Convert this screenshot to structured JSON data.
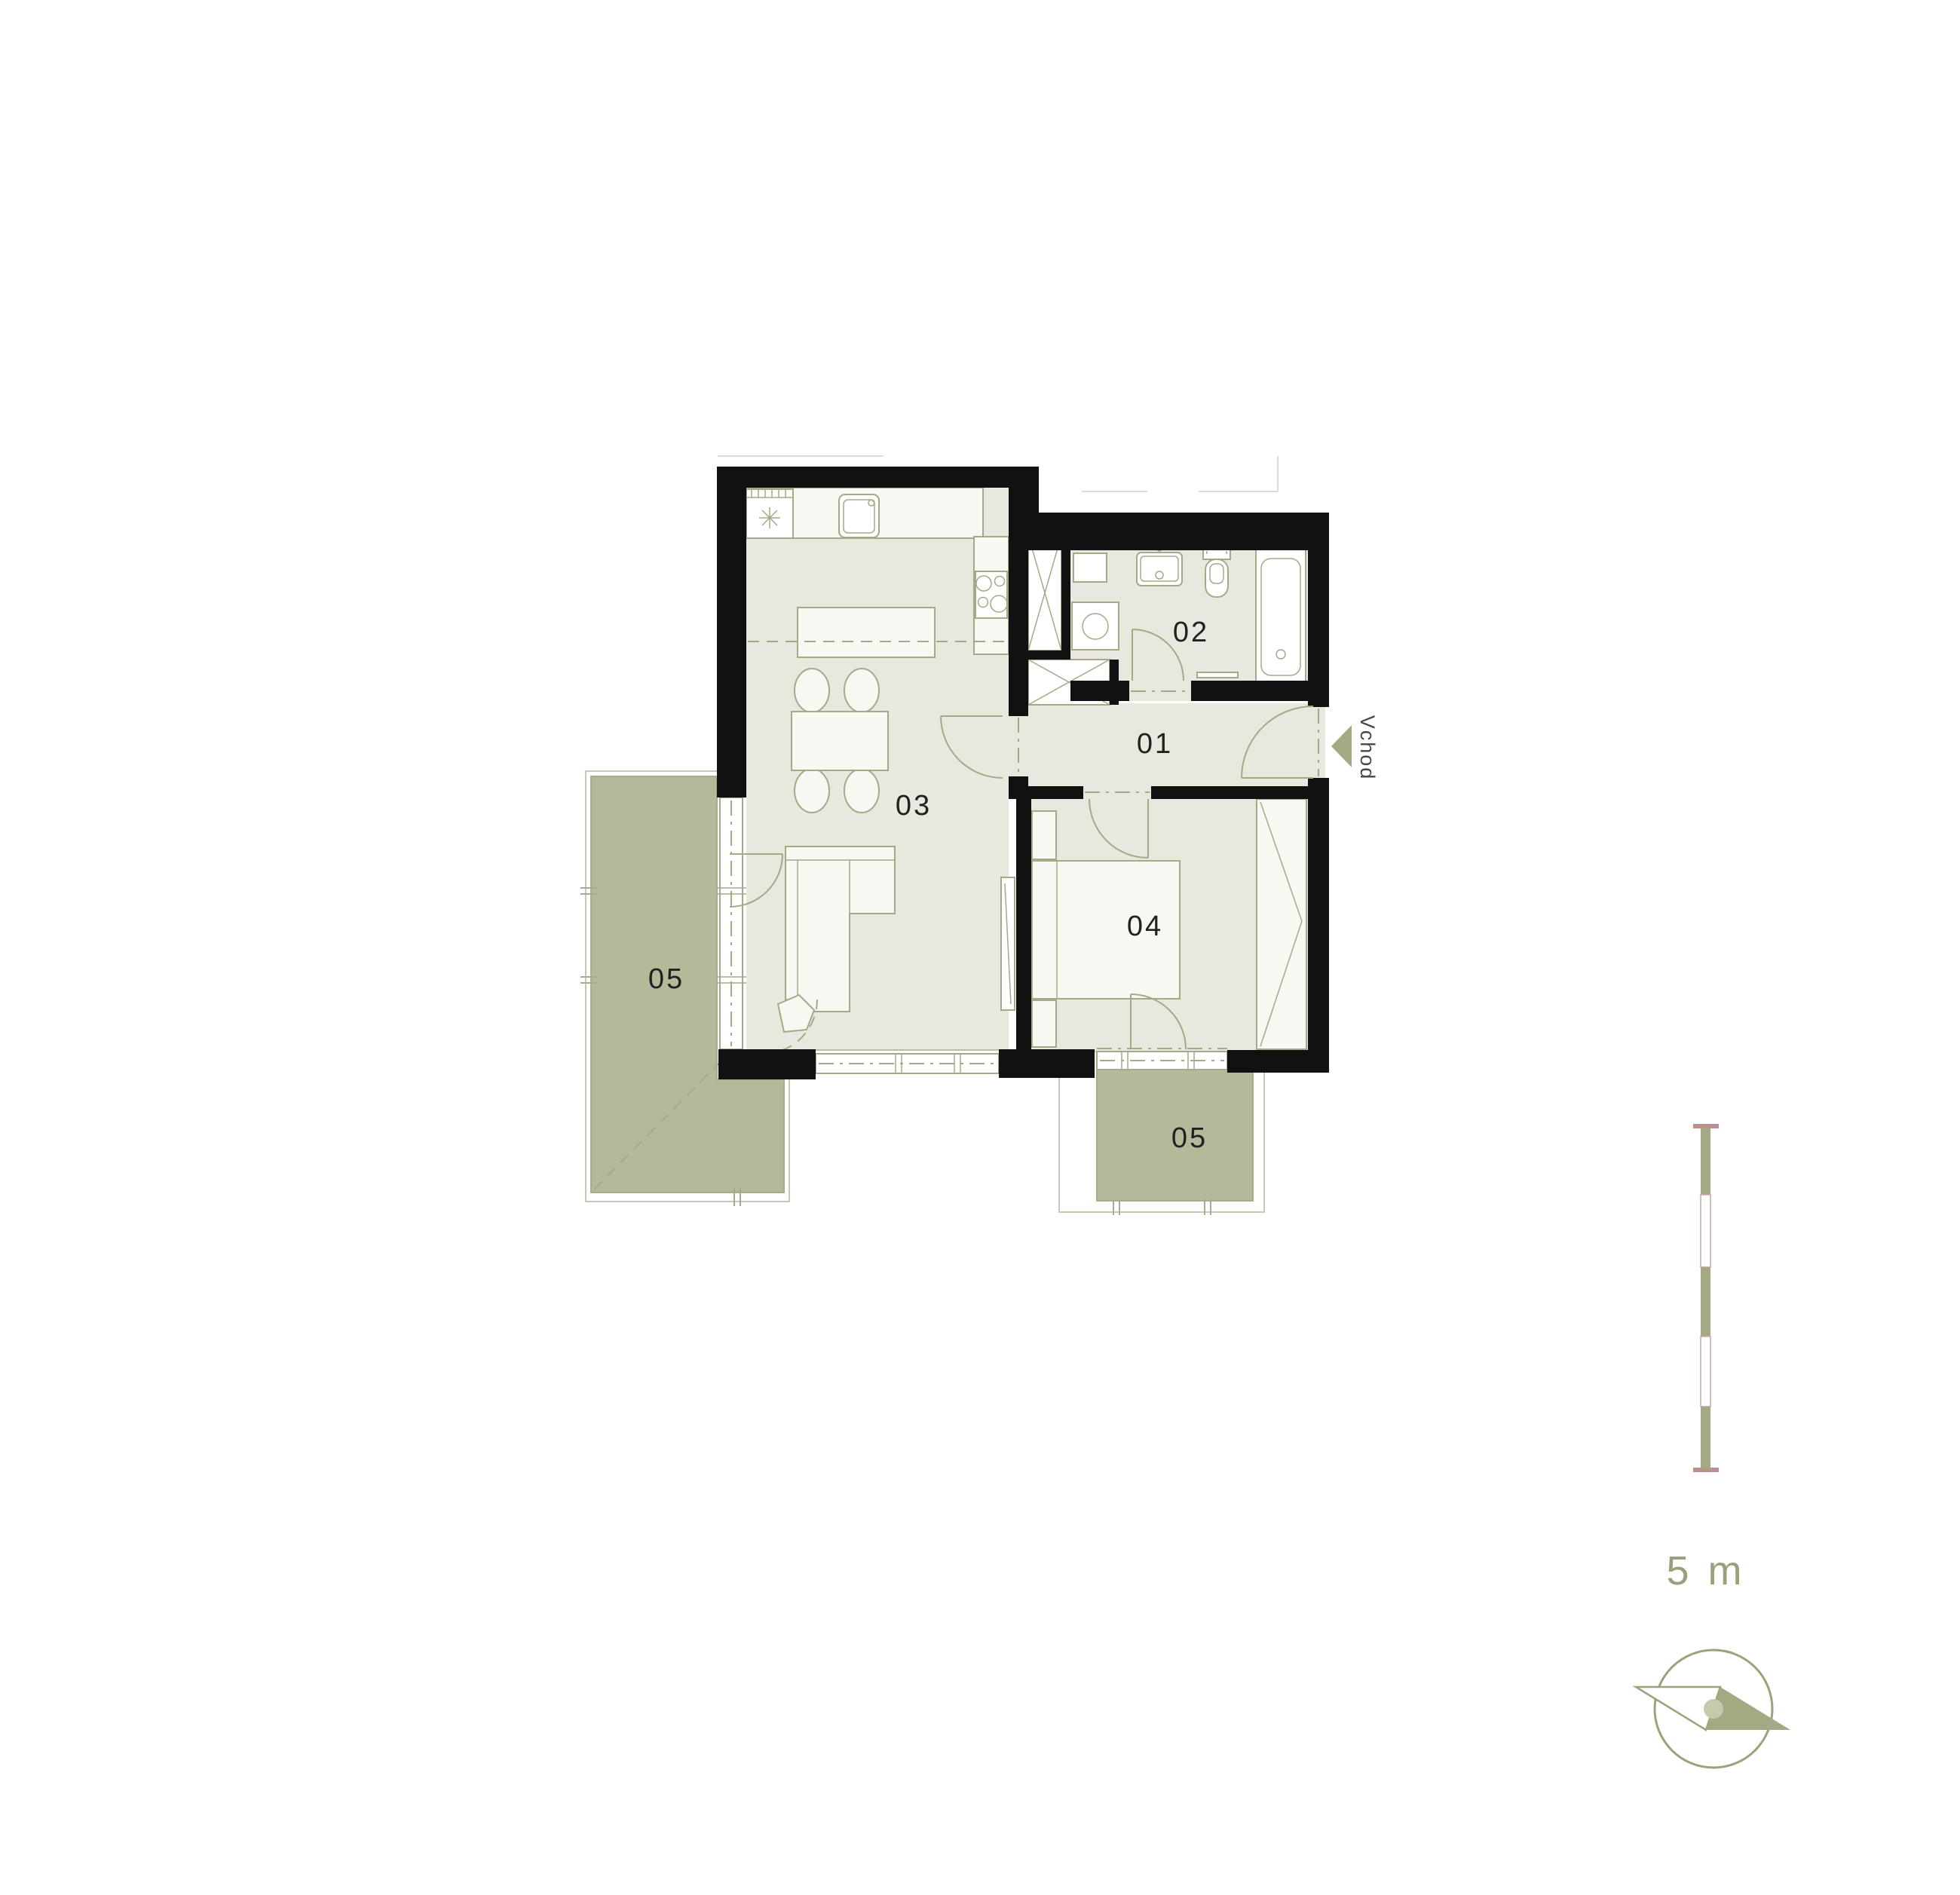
{
  "rooms": {
    "hallway": {
      "label": "01"
    },
    "bathroom": {
      "label": "02"
    },
    "living": {
      "label": "03"
    },
    "bedroom": {
      "label": "04"
    },
    "balcony_left": {
      "label": "05"
    },
    "balcony_bottom": {
      "label": "05"
    }
  },
  "entrance": {
    "label": "Vchod"
  },
  "scale_bar": {
    "label": "5 m",
    "length_meters": 5
  },
  "colors": {
    "wall": "#111111",
    "floor": "#e9e8df",
    "furniture": "#f8f8f3",
    "line": "#a6a888",
    "balcony": "#b6b89a",
    "balcony-line": "#a9ab8e",
    "slab": "#c6c8b2",
    "label": "#212121",
    "scale-olive": "#a5a883",
    "scale-pink": "#bd8e8d",
    "scale-pink-light": "#c9a5a4",
    "scale-text": "#9aa07c",
    "compass": "#9aa37b",
    "compass-fill": "#a3a982",
    "entrance-text": "#474747",
    "ghost": "#dcdcd2"
  }
}
